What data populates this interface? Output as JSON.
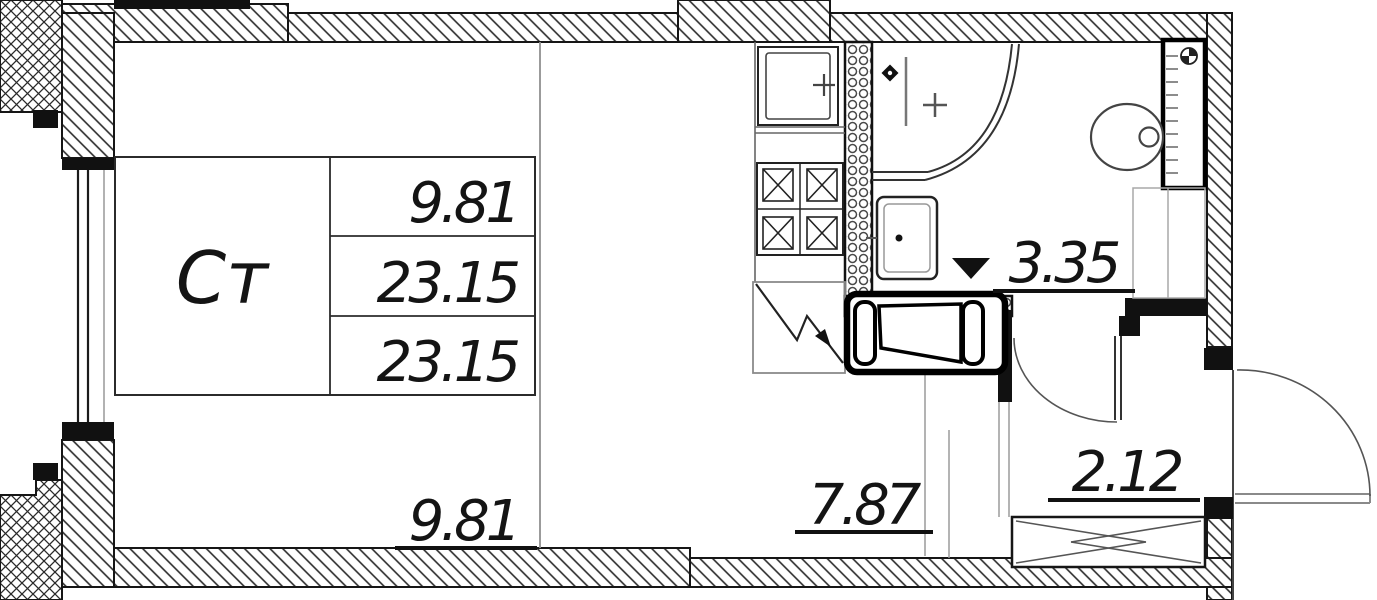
{
  "unit": {
    "type_label": "Ст"
  },
  "info_table": {
    "rows": [
      "9.81",
      "23.15",
      "23.15"
    ]
  },
  "areas": {
    "living": "9.81",
    "kitchen": "7.87",
    "bathroom": "3.35",
    "hallway": "2.12"
  },
  "colors": {
    "line": "#161616",
    "gray_line": "#909090",
    "background": "#ffffff"
  }
}
